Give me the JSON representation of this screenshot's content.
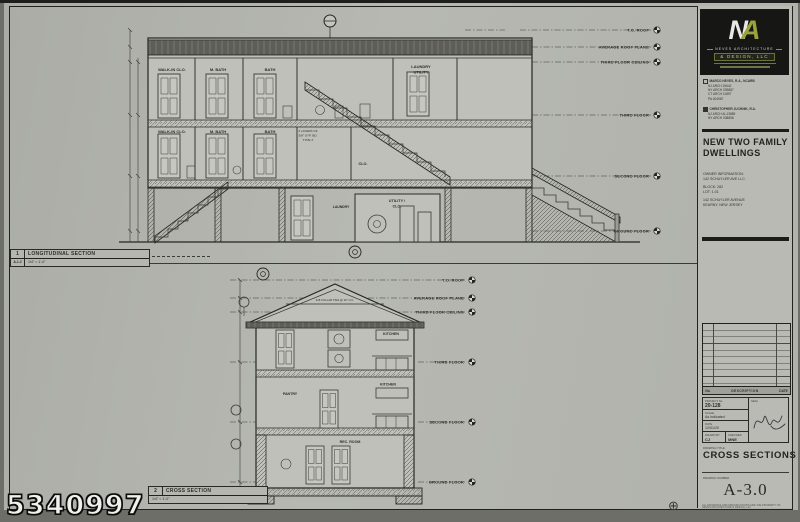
{
  "watermark": "5340997",
  "icons": {
    "registration_mark": "⊕"
  },
  "brand": {
    "monogram_n": "N",
    "monogram_a": "A",
    "firm_name": "NEVES ARCHITECTURE",
    "firm_suffix": "& DESIGN, LLC",
    "accent_color": "#9aa23a"
  },
  "architects": {
    "principal_name": "MARCO NEVES, R.A., NCARB",
    "principal_lines": [
      "NJ ARCH 15642",
      "NY ARCH 039887",
      "CT ARCH 11897",
      "PA 404987"
    ],
    "associate_name": "CHRISTOPHER JUCHNIK, R.A.",
    "associate_lines": [
      "NJ ARCH AI-13889",
      "NY ARCH 038898"
    ]
  },
  "project": {
    "title_line1": "NEW TWO FAMILY",
    "title_line2": "DWELLINGS",
    "owner_label": "OWNER INFORMATION:",
    "owner_name": "142 SCHUYLER AVE LLC.",
    "block": "BLOCK: 282",
    "lot": "LOT: 1.01",
    "address_line1": "142 SCHUYLER AVENUE",
    "address_line2": "KEARNY, NEW JERSEY"
  },
  "revisions": {
    "no_label": "No.",
    "description_label": "DESCRIPTION",
    "date_label": "DATE"
  },
  "title_block": {
    "project_no_label": "PROJECT No.",
    "project_no": "20-128",
    "seal_label": "SEAL",
    "scale_label": "SCALE",
    "scale_value": "As indicated",
    "date_label": "DATE",
    "date_value": "12/01/20",
    "drawn_by_label": "DRAWN BY",
    "drawn_by": "CJ",
    "checked_label": "CHECKED",
    "checked_by": "MNE",
    "drawing_title_label": "DRAWING TITLE",
    "drawing_title": "CROSS SECTIONS",
    "drawing_no_label": "DRAWING NUMBER",
    "drawing_no": "A-3.0",
    "copyright1": "ALL DRAWINGS AND SPECIFICATIONS ARE THE PROPERTY OF",
    "copyright2": "NEVES ARCHITECTURE & DESIGN, LLC"
  },
  "longitudinal": {
    "tag_number": "1",
    "tag_sheet": "A-1.2",
    "title": "LONGITUDINAL SECTION",
    "scale": "1/4\" = 1'-0\"",
    "levels": [
      "T.O. ROOF",
      "AVERAGE ROOF PLANE",
      "THIRD FLOOR CEILING",
      "THIRD FLOOR",
      "SECOND FLOOR",
      "GROUND FLOOR"
    ],
    "rooms_third": [
      "WALK-IN CLO.",
      "M. BATH",
      "BATH"
    ],
    "laundry_line1": "LAUNDRY",
    "laundry_line2": "UTILITY",
    "rooms_second": [
      "WALK-IN CLO.",
      "M. BATH",
      "BATH"
    ],
    "closet": "CLO.",
    "utility_line1": "UTILITY /",
    "utility_line2": "CLO.",
    "laundry_small": "LAUNDRY",
    "note_line1": "2 LAYERS OF",
    "note_line2": "5/8\" GYP. BD.",
    "note_line3": "TYPE X"
  },
  "cross": {
    "tag_number": "2",
    "title": "CROSS SECTION",
    "scale": "1/4\" = 1'-0\"",
    "levels": [
      "T.O. ROOF",
      "AVERAGE ROOF PLANE",
      "THIRD FLOOR CEILING",
      "THIRD FLOOR",
      "SECOND FLOOR",
      "GROUND FLOOR"
    ],
    "attic_note": "2x8 COLLAR TIES @ 16\" O.C.",
    "kitchen_third": "KITCHEN",
    "pantry": "PANTRY",
    "kitchen_second": "KITCHEN",
    "rec_room": "REC. ROOM"
  }
}
